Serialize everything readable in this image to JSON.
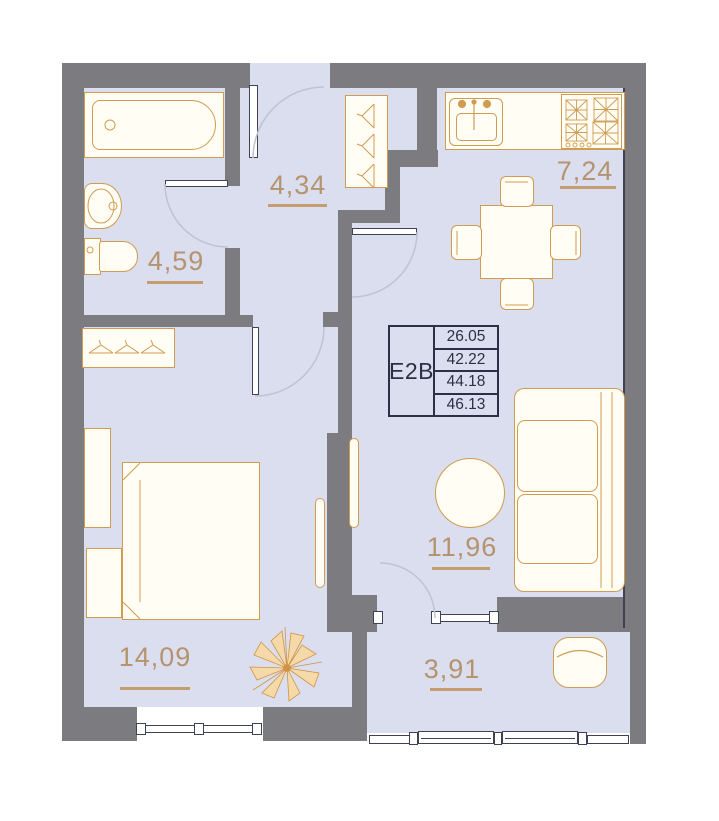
{
  "unit": {
    "code": "E2B",
    "stats": [
      "26.05",
      "42.22",
      "44.18",
      "46.13"
    ]
  },
  "rooms": {
    "hallway": {
      "area": "4,34"
    },
    "bathroom": {
      "area": "4,59"
    },
    "kitchen": {
      "area": "7,24"
    },
    "living": {
      "area": "11,96"
    },
    "bedroom": {
      "area": "14,09"
    },
    "balcony": {
      "area": "3,91"
    }
  },
  "icons": {
    "bathtub": "bathtub-icon",
    "sink": "sink-icon",
    "toilet": "toilet-icon",
    "stove": "stove-icon",
    "kitchen_sink": "kitchen-sink-icon",
    "dining_table": "dining-table-icon",
    "sofa": "sofa-icon",
    "round_table": "round-table-icon",
    "bed": "bed-icon",
    "wardrobe": "wardrobe-icon",
    "coat_rack": "coat-rack-icon",
    "plant": "plant-icon",
    "armchair": "armchair-icon"
  },
  "colors": {
    "wall": "#7b7b80",
    "floor": "#dbdeee",
    "furniture_fill": "#fffdf4",
    "furniture_outline": "#d09c50",
    "room_label": "#b5936e",
    "frame": "#3f4254",
    "unit_box": "#2b3042",
    "door_arc": "#bfc3cf"
  }
}
